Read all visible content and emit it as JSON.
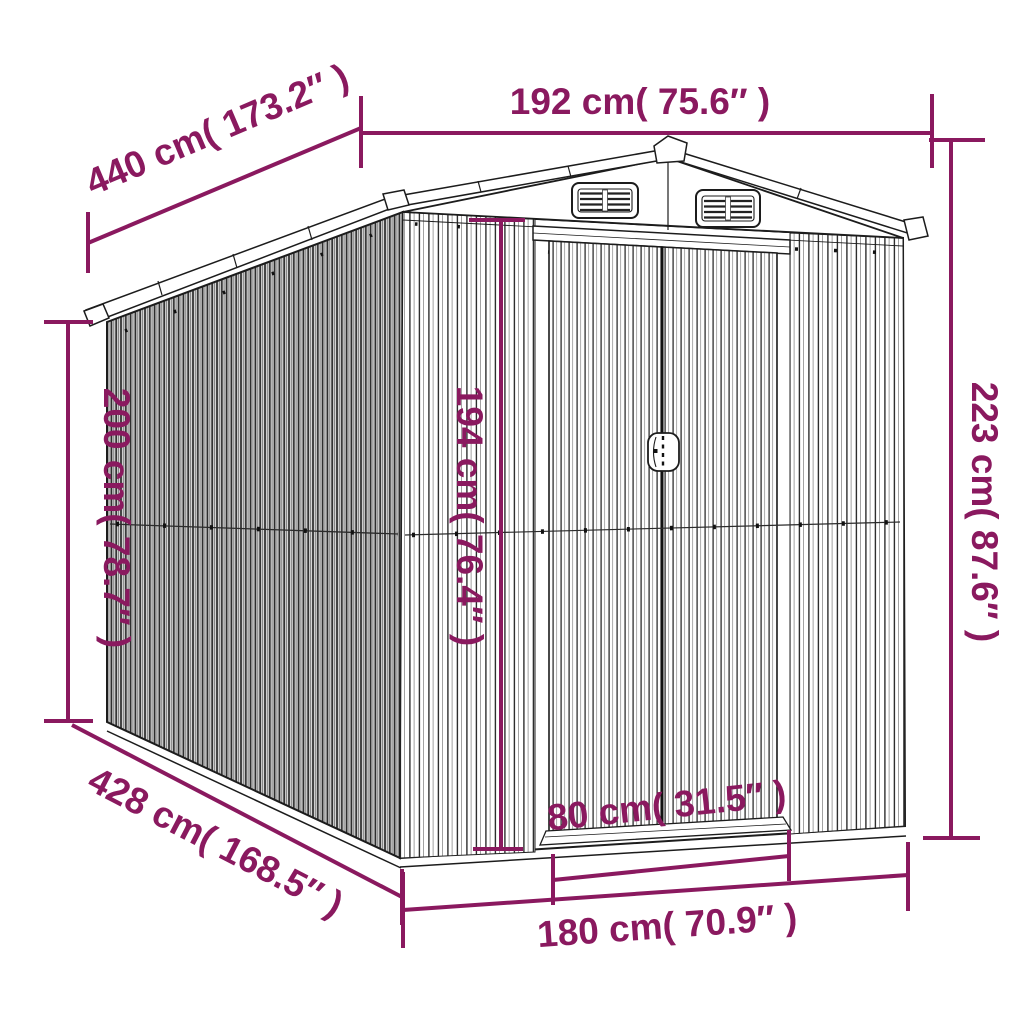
{
  "diagram": {
    "subject": "metal garden shed 3D line drawing with dimension annotations",
    "background_color": "#ffffff",
    "accent_color": "#8a195f",
    "line_color": "#1c1c1c"
  },
  "dimensions": {
    "roof_width_top": "192 cm( 75.6″ )",
    "side_length_top": "440 cm( 173.2″ )",
    "rear_wall_height": "200 cm( 78.7″ )",
    "total_height": "223 cm( 87.6″ )",
    "door_height": "194 cm( 76.4″ )",
    "side_length_bottom": "428 cm( 168.5″ )",
    "door_width": "80 cm( 31.5″ )",
    "front_width_bottom": "180 cm( 70.9″ )"
  }
}
